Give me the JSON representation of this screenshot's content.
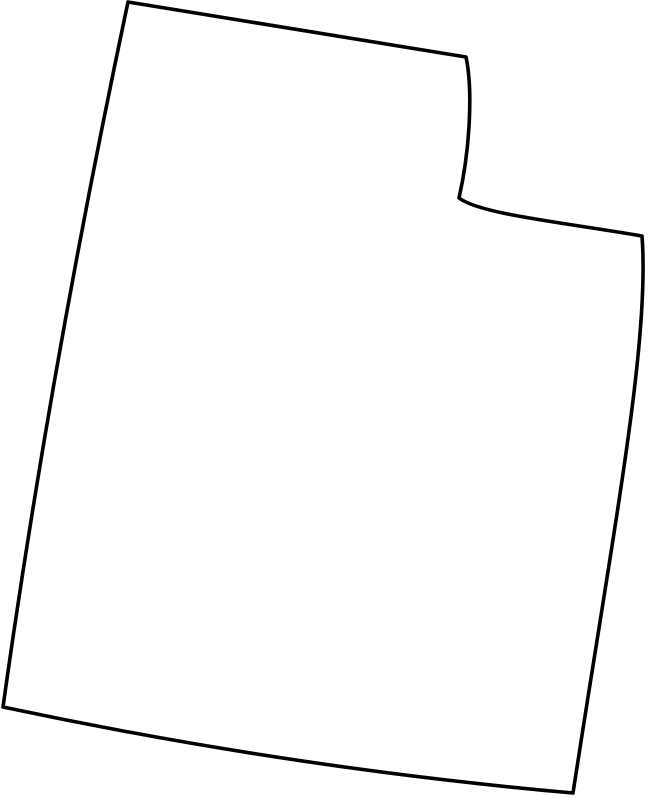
{
  "map": {
    "shape_name": "utah-state-outline",
    "background_color": "#ffffff",
    "outline": {
      "viewbox": "0 0 649 800",
      "path": "M 128,2 L 466,57 C 473,90 470,150 459,198 C 480,214 560,222 642,236 C 650,340 615,520 573,793 Q 290,768 3,707 Q 50,370 128,2 Z",
      "stroke_color": "#000000",
      "stroke_width": "3.6",
      "fill_color": "#ffffff",
      "linejoin": "round",
      "linecap": "round"
    }
  }
}
